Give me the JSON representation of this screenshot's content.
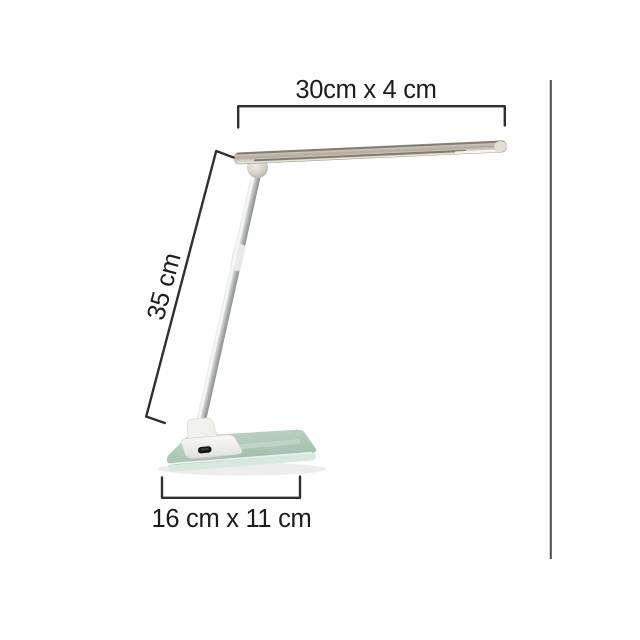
{
  "diagram": {
    "type": "product-dimension-diagram",
    "subject": "desk-lamp-with-glass-base",
    "labels": {
      "head_dimension": "30cm x 4 cm",
      "arm_length": "35 cm",
      "base_dimension": "16 cm x 11 cm"
    },
    "colors": {
      "background": "#ffffff",
      "dimension_line": "#2f2f2f",
      "label_text": "#1c1c1c",
      "divider_line": "#4c4c4c",
      "head_metal": "#b3aa9d",
      "arm_metal": "#b9bcbe",
      "hinge_ball": "#d5d0c6",
      "mount_plastic": "#f0f0ed",
      "power_button": "#161616",
      "glass_top": "#b4ccbb",
      "glass_edge": "#d9e8de"
    }
  }
}
